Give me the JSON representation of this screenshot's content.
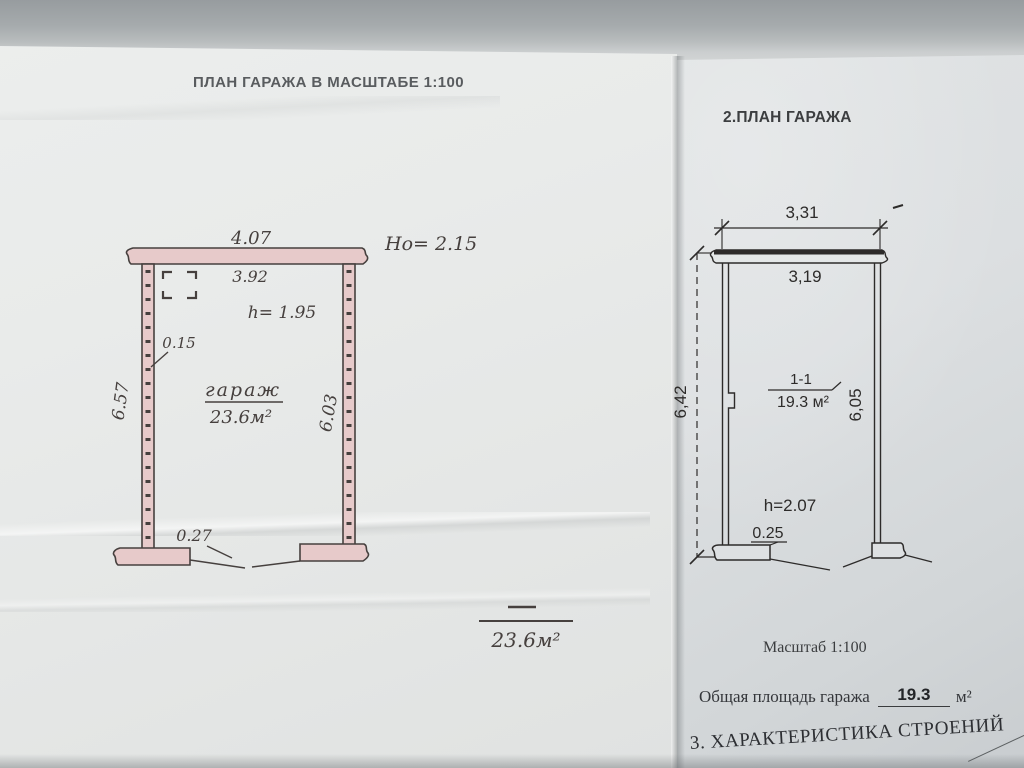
{
  "left_sheet": {
    "title": "ПЛАН ГАРАЖА В МАСШТАБЕ 1:100",
    "plan": {
      "outer_width": "4.07",
      "inner_width": "3.92",
      "gate_height": "Hо= 2.15",
      "inner_height": "h= 1.95",
      "wall_thickness": "0.15",
      "left_depth": "6.57",
      "right_depth": "6.03",
      "room_label": "гараж",
      "room_area": "23.6м²",
      "footing_width": "0.27"
    },
    "summary_area": "23.6м²"
  },
  "right_sheet": {
    "title": "2.ПЛАН ГАРАЖА",
    "plan": {
      "outer_width": "3,31",
      "inner_width": "3,19",
      "left_depth": "6,42",
      "right_depth": "6,05",
      "section_label": "1-1",
      "room_area": "19.3 м²",
      "inner_height": "h=2.07",
      "footing_width": "0.25"
    },
    "scale_note": "Масштаб 1:100",
    "total_area_label": "Общая площадь гаража",
    "total_area_value": "19.3",
    "total_area_unit": "м²",
    "next_section_heading": "3. ХАРАКТЕРИСТИКА СТРОЕНИЙ"
  },
  "colors": {
    "background_gray": "#a2a7aa",
    "paper_left": "#e9ebea",
    "paper_right": "#dcdfe1",
    "ink_left": "#46403e",
    "ink_right": "#2d2b2a",
    "wall_fill_pink": "#e7caca"
  }
}
